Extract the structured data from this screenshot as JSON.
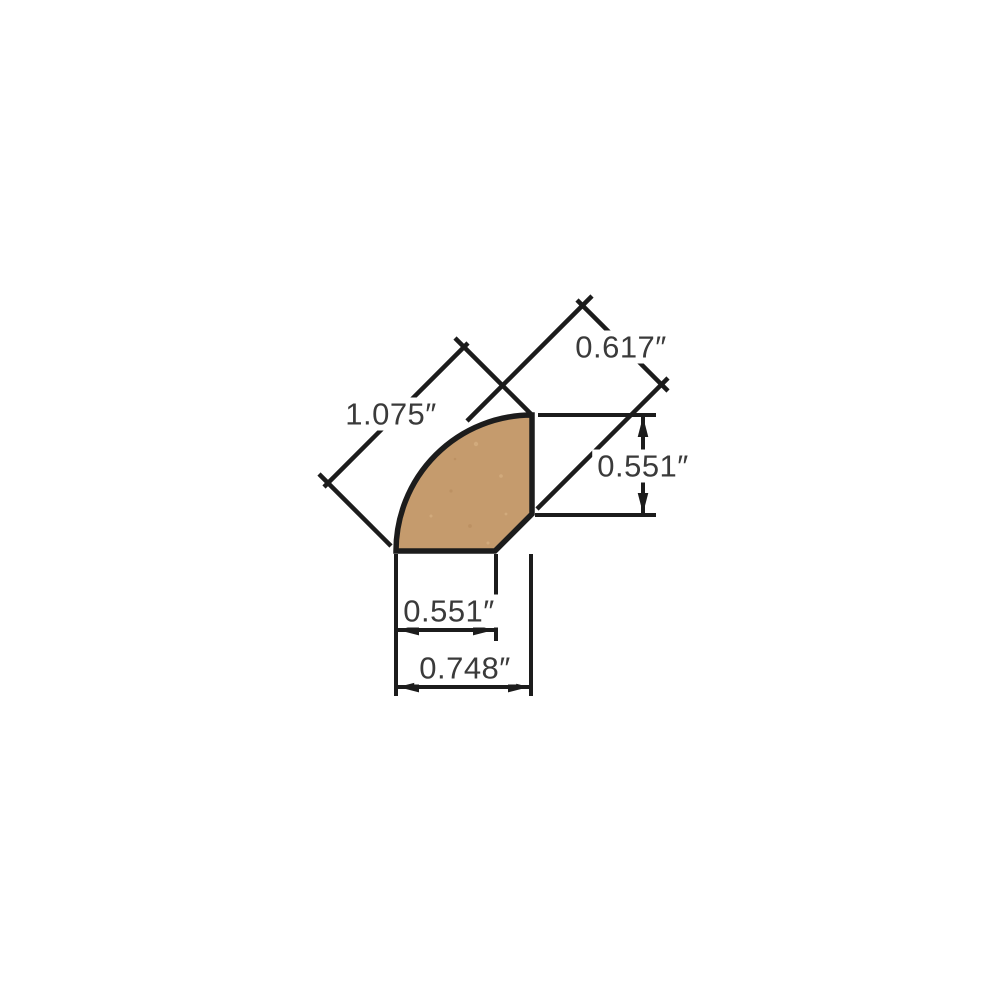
{
  "colors": {
    "background": "#FFFFFF",
    "wood_fill": "#C59B6D",
    "speckle_light": "#DCB789",
    "speckle_dark": "#B68A5C",
    "line": "#1C1C1C",
    "label_text": "#3A3A3A"
  },
  "dimension_labels": {
    "diagonal_length": "1.075″",
    "diagonal_face_height": "0.617″",
    "right_side_height": "0.551″",
    "bottom_inner_width": "0.551″",
    "bottom_outer_width": "0.748″"
  }
}
